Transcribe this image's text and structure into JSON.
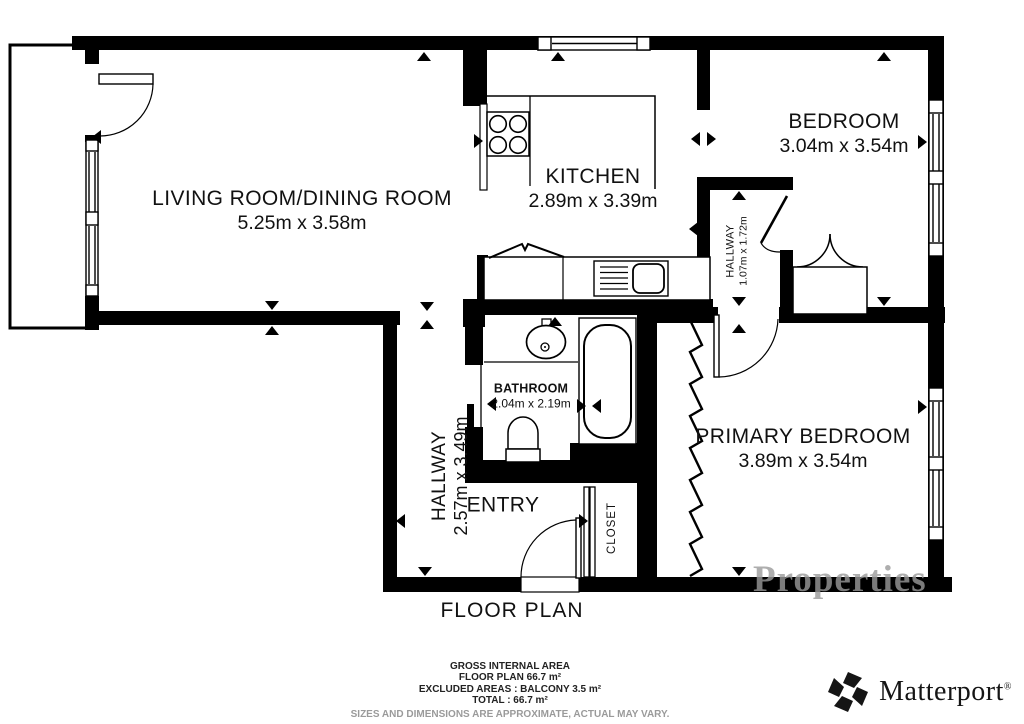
{
  "plan": {
    "title": "FLOOR PLAN",
    "rooms": {
      "living": {
        "name": "LIVING ROOM/DINING ROOM",
        "dims": "5.25m x 3.58m"
      },
      "kitchen": {
        "name": "KITCHEN",
        "dims": "2.89m x 3.39m"
      },
      "bedroom": {
        "name": "BEDROOM",
        "dims": "3.04m x 3.54m"
      },
      "hallway_upper": {
        "name": "HALLWAY",
        "dims": "1.07m x 1.72m"
      },
      "bathroom": {
        "name": "BATHROOM",
        "dims": "2.04m x 2.19m"
      },
      "hallway_main": {
        "name": "HALLWAY",
        "dims": "2.57m x 3.49m"
      },
      "primary_bedroom": {
        "name": "PRIMARY BEDROOM",
        "dims": "3.89m x 3.54m"
      },
      "entry": {
        "name": "ENTRY"
      },
      "closet": {
        "name": "CLOSET"
      }
    }
  },
  "footer": {
    "line1": "GROSS INTERNAL AREA",
    "line2": "FLOOR PLAN 66.7 m²",
    "line3": "EXCLUDED AREAS :  BALCONY 3.5 m²",
    "line4": "TOTAL :  66.7 m²",
    "disclaimer": "SIZES AND DIMENSIONS ARE APPROXIMATE, ACTUAL MAY VARY."
  },
  "branding": {
    "name": "Matterport",
    "mark": "®"
  },
  "watermark": {
    "text": "Properties"
  },
  "colors": {
    "wall": "#000000",
    "text": "#111111",
    "muted": "#9a9a9a"
  }
}
